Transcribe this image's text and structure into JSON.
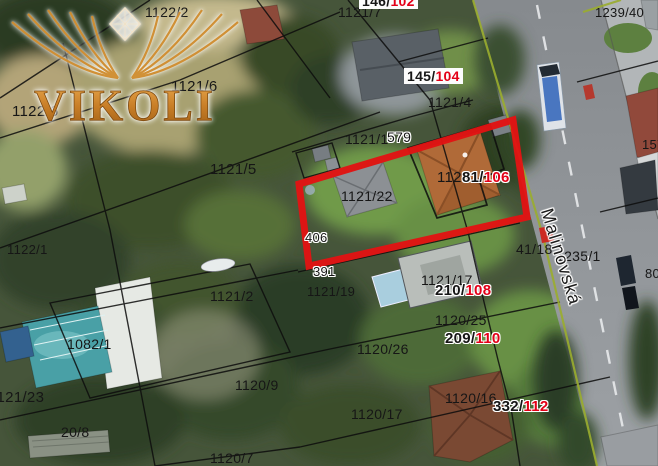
{
  "map": {
    "watermark": {
      "text": "VIKOLI"
    },
    "street": {
      "name": "Malinovská"
    },
    "colors": {
      "parcel_text": "#161616",
      "address_red": "#e30017",
      "highlight": "#e21313",
      "boundary": "#0d0d0d",
      "road_edge_green": "#9aad2e"
    },
    "labels": [
      {
        "x": 145,
        "y": 5,
        "fs": 14,
        "parts": [
          [
            "1122/2",
            "k"
          ]
        ]
      },
      {
        "x": 338,
        "y": 5,
        "fs": 14,
        "parts": [
          [
            "1121/7",
            "k"
          ]
        ]
      },
      {
        "x": 360,
        "y": -6,
        "fs": 14,
        "b": 1,
        "bg": 1,
        "parts": [
          [
            "146/",
            "k"
          ],
          [
            "102",
            "r"
          ]
        ]
      },
      {
        "x": 171,
        "y": 79,
        "fs": 15,
        "parts": [
          [
            "1121/6",
            "k"
          ]
        ]
      },
      {
        "x": 405,
        "y": 69,
        "fs": 14,
        "b": 1,
        "bg": 1,
        "parts": [
          [
            "145/",
            "k"
          ],
          [
            "104",
            "r"
          ]
        ]
      },
      {
        "x": 428,
        "y": 95,
        "fs": 14,
        "parts": [
          [
            "1121/4",
            "k"
          ]
        ]
      },
      {
        "x": 12,
        "y": 104,
        "fs": 15,
        "parts": [
          [
            "1122/6",
            "k"
          ]
        ]
      },
      {
        "x": 210,
        "y": 162,
        "fs": 15,
        "parts": [
          [
            "1121/5",
            "k"
          ]
        ]
      },
      {
        "x": 345,
        "y": 132,
        "fs": 14,
        "parts": [
          [
            "1121/1",
            "k"
          ]
        ]
      },
      {
        "x": 387,
        "y": 130,
        "fs": 14,
        "halo": 1,
        "parts": [
          [
            "579",
            "k"
          ]
        ]
      },
      {
        "x": 341,
        "y": 189,
        "fs": 14,
        "parts": [
          [
            "1121/22",
            "k"
          ]
        ]
      },
      {
        "x": 437,
        "y": 170,
        "fs": 15,
        "parts": [
          [
            "112",
            "k"
          ]
        ]
      },
      {
        "x": 462,
        "y": 170,
        "fs": 15,
        "b": 1,
        "halo": 1,
        "parts": [
          [
            "81/",
            "k"
          ],
          [
            "106",
            "r"
          ]
        ]
      },
      {
        "x": 595,
        "y": 6,
        "fs": 13,
        "parts": [
          [
            "1239/40",
            "k"
          ]
        ]
      },
      {
        "x": 642,
        "y": 138,
        "fs": 13,
        "parts": [
          [
            "157",
            "k"
          ]
        ]
      },
      {
        "x": 516,
        "y": 242,
        "fs": 14,
        "parts": [
          [
            "41/18",
            "k"
          ]
        ]
      },
      {
        "x": 556,
        "y": 249,
        "fs": 14,
        "parts": [
          [
            "1235/1",
            "k"
          ]
        ]
      },
      {
        "x": 305,
        "y": 231,
        "fs": 13,
        "halo": 1,
        "parts": [
          [
            "406",
            "k"
          ]
        ]
      },
      {
        "x": 313,
        "y": 265,
        "fs": 13,
        "halo": 1,
        "parts": [
          [
            "391",
            "k"
          ]
        ]
      },
      {
        "x": 307,
        "y": 285,
        "fs": 13,
        "parts": [
          [
            "1121/19",
            "k"
          ]
        ]
      },
      {
        "x": 210,
        "y": 289,
        "fs": 14,
        "parts": [
          [
            "1121/2",
            "k"
          ]
        ]
      },
      {
        "x": 421,
        "y": 273,
        "fs": 14,
        "parts": [
          [
            "1121/17",
            "k"
          ]
        ]
      },
      {
        "x": 435,
        "y": 283,
        "fs": 15,
        "b": 1,
        "halo": 1,
        "parts": [
          [
            "210/",
            "k"
          ],
          [
            "108",
            "r"
          ]
        ]
      },
      {
        "x": 435,
        "y": 313,
        "fs": 14,
        "parts": [
          [
            "1120/25",
            "k"
          ]
        ]
      },
      {
        "x": 445,
        "y": 331,
        "fs": 15,
        "b": 1,
        "halo": 1,
        "parts": [
          [
            "209/",
            "k"
          ],
          [
            "110",
            "r"
          ]
        ]
      },
      {
        "x": 357,
        "y": 342,
        "fs": 14,
        "parts": [
          [
            "1120/26",
            "k"
          ]
        ]
      },
      {
        "x": 67,
        "y": 337,
        "fs": 14,
        "parts": [
          [
            "1082/1",
            "k"
          ]
        ]
      },
      {
        "x": -11,
        "y": 390,
        "fs": 15,
        "parts": [
          [
            "1121/23",
            "k"
          ]
        ]
      },
      {
        "x": 235,
        "y": 378,
        "fs": 14,
        "parts": [
          [
            "1120/9",
            "k"
          ]
        ]
      },
      {
        "x": 445,
        "y": 391,
        "fs": 14,
        "parts": [
          [
            "1120/16",
            "k"
          ]
        ]
      },
      {
        "x": 493,
        "y": 399,
        "fs": 15,
        "b": 1,
        "halo": 1,
        "parts": [
          [
            "332/",
            "k"
          ],
          [
            "112",
            "r"
          ]
        ]
      },
      {
        "x": 351,
        "y": 407,
        "fs": 14,
        "parts": [
          [
            "1120/17",
            "k"
          ]
        ]
      },
      {
        "x": 61,
        "y": 425,
        "fs": 14,
        "parts": [
          [
            "20/8",
            "k"
          ]
        ]
      },
      {
        "x": 210,
        "y": 451,
        "fs": 14,
        "parts": [
          [
            "1120/7",
            "k"
          ]
        ]
      },
      {
        "x": 7,
        "y": 243,
        "fs": 13,
        "parts": [
          [
            "1122/1",
            "k"
          ]
        ]
      },
      {
        "x": 645,
        "y": 267,
        "fs": 13,
        "parts": [
          [
            "80",
            "k"
          ]
        ]
      }
    ]
  }
}
